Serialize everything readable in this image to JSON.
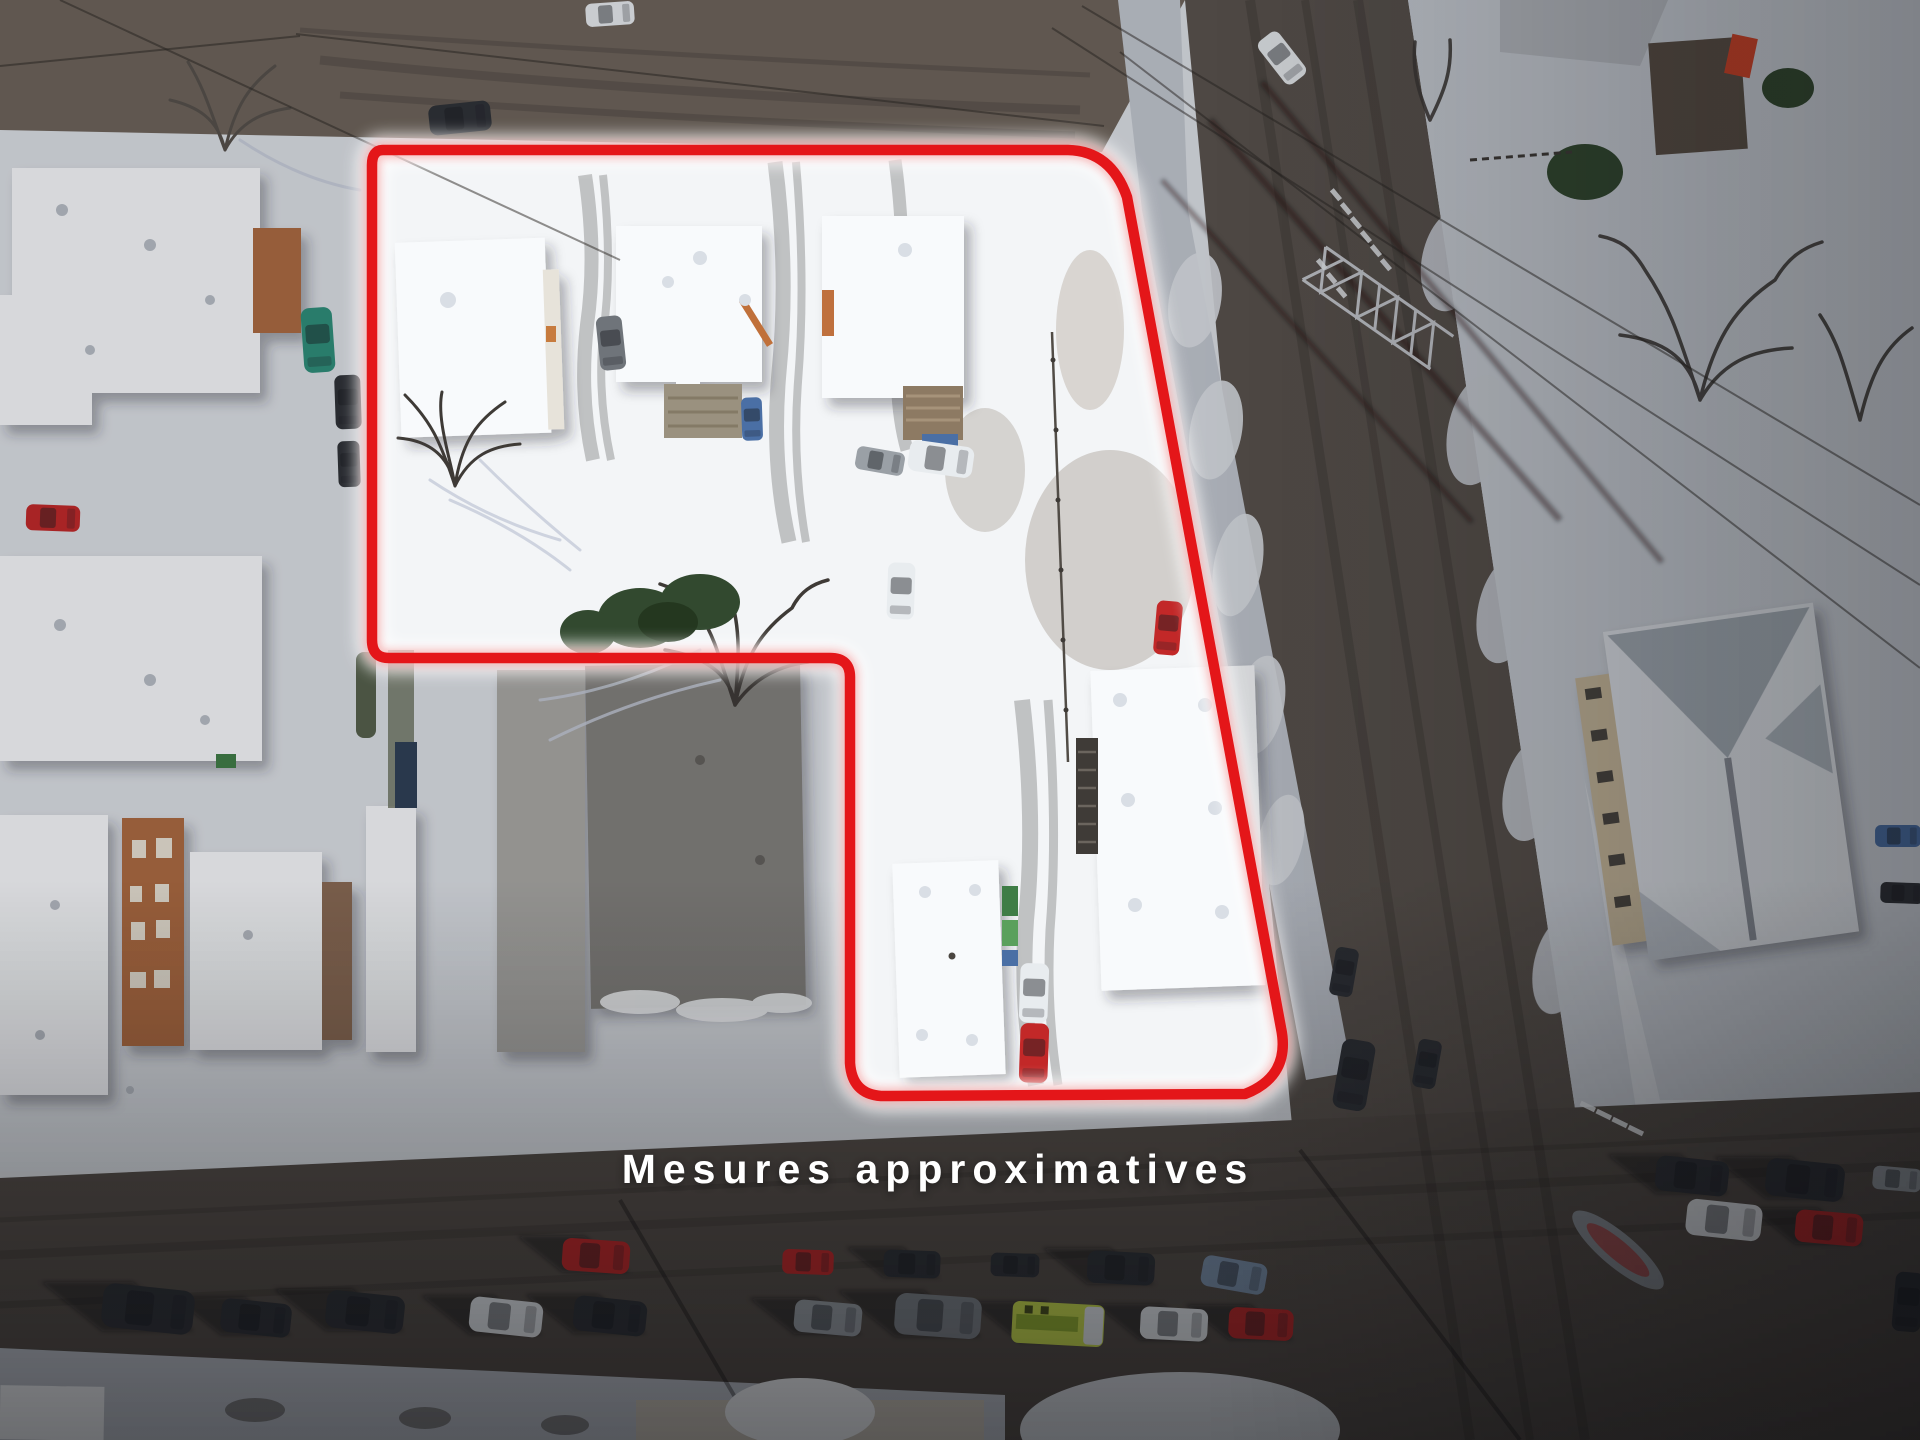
{
  "label": {
    "text": "Mesures approximatives"
  },
  "boundary": {
    "path": "M 383 150 L 1068 150 Q 1111 151 1127 197 L 1281 1028 Q 1291 1076 1245 1094 L 881 1096 Q 852 1094 850 1063 L 850 677 Q 850 658 830 658 L 389 658 Q 372 658 372 640 L 372 165 Q 372 150 383 150 Z",
    "color": "#e41619",
    "glow_color": "#ffffff"
  },
  "palette": {
    "snow_bright": "#f3f5f7",
    "snow": "#dde1e6",
    "snow_dim": "#cdd2d9",
    "sidewalk": "#c2c7cf",
    "road_alley": "#6e645a",
    "road_main": "#59524c",
    "road_cross": "#544d47",
    "mud": "#8a7560",
    "mud_dark": "#6f5d4b",
    "roof_white": "#f8fafc",
    "roof_shade": "#e2e6eb",
    "roof_gray_light": "#a9a8a4",
    "roof_gray": "#82807c",
    "brick": "#ad6a41",
    "brick_dark": "#8a6a52",
    "facade_tan": "#cbbc9e",
    "evergreen": "#32492f",
    "branch": "#55504a",
    "branch_dark": "#3e3a36",
    "car_dark": "#2e3136",
    "car_gray": "#9aa0a6",
    "car_white": "#e8ecef",
    "car_red": "#c22828",
    "car_blue": "#4a6fa5",
    "car_teal": "#2e8f7a",
    "ambulance_green": "#cde04d",
    "yellow_mark": "#d9b13b",
    "boundary_red": "#e41619"
  },
  "scene": {
    "type": "winter aerial drone photo",
    "visible_objects": [
      "snow-covered residential block",
      "property lot outlined in red",
      "gray flat-roof commercial building",
      "white flat-roof commercial building",
      "gabled-roof building with parking lot",
      "power transmission tower and overhead lines",
      "parked cars along streets",
      "yellow-green ambulance",
      "snowy yards and muddy driveways"
    ]
  }
}
